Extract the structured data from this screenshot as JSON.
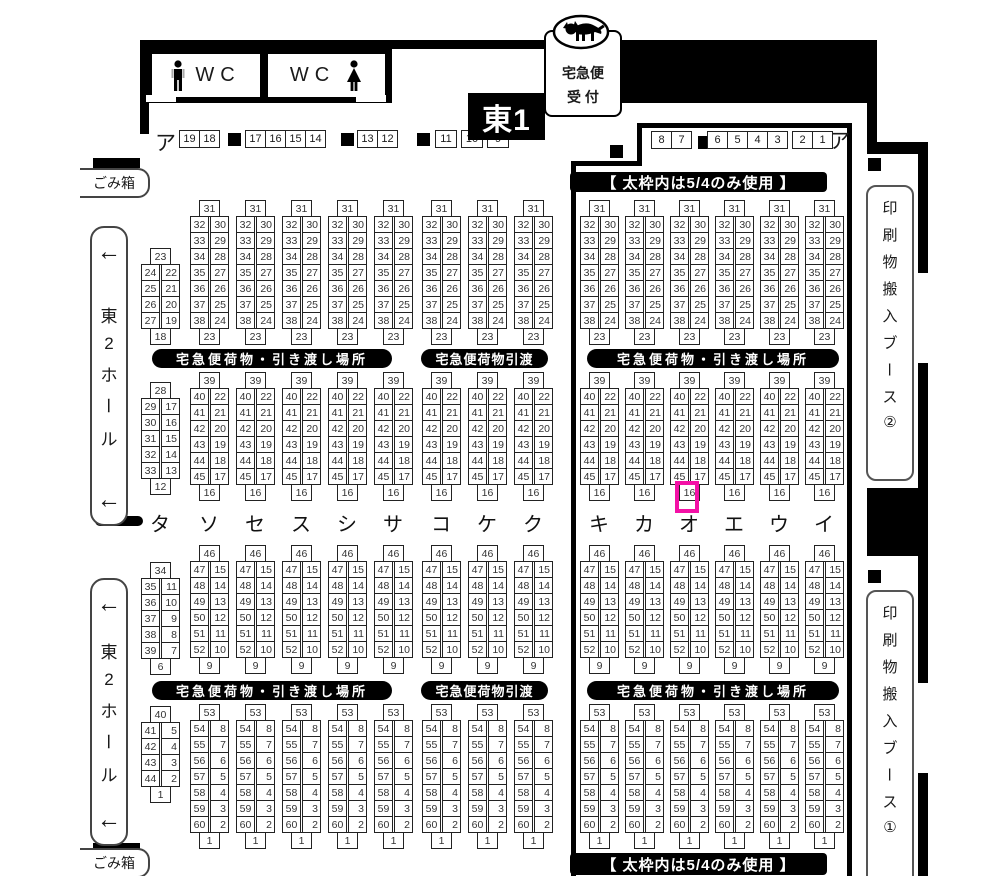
{
  "hall": {
    "name": "東1"
  },
  "courier_sign": {
    "line1": "宅急便",
    "line2": "受 付"
  },
  "wc": {
    "left_label": "WC",
    "right_label": "WC"
  },
  "trash": {
    "top_label": "ごみ箱",
    "bottom_label": "ごみ箱"
  },
  "hall2_sign": {
    "arrow_top": "←",
    "chars": [
      "東",
      "2",
      "ホ",
      "ー",
      "ル"
    ],
    "arrow_bottom": "←"
  },
  "print_booths": {
    "booth2_chars": [
      "印",
      "刷",
      "物",
      "搬",
      "入",
      "ブ",
      "ー",
      "ス",
      "②"
    ],
    "booth1_chars": [
      "印",
      "刷",
      "物",
      "搬",
      "入",
      "ブ",
      "ー",
      "ス",
      "①"
    ]
  },
  "notices": {
    "frame_top": "【 太枠内は5/4のみ使用 】",
    "frame_bottom": "【 太枠内は5/4のみ使用 】"
  },
  "bars": {
    "wide_label": "宅急便荷物・引き渡し場所",
    "narrow_label": "宅急便荷物引渡"
  },
  "row_a": {
    "label_left": "ア",
    "label_right": "ア",
    "left_groups": [
      [
        "19",
        "18"
      ],
      [
        "17",
        "16",
        "15",
        "14"
      ],
      [
        "13",
        "12"
      ]
    ],
    "left_singles": [
      "11",
      "10",
      "9"
    ],
    "right_groups": [
      [
        "8",
        "7"
      ],
      [
        "6",
        "5",
        "4",
        "3"
      ],
      [
        "2",
        "1"
      ]
    ]
  },
  "booth_grid": {
    "partial_column": {
      "label": "タ",
      "sections": [
        {
          "top": "23",
          "rows": [
            [
              "24",
              "22"
            ],
            [
              "25",
              "21"
            ],
            [
              "26",
              "20"
            ],
            [
              "27",
              "19"
            ]
          ],
          "bottom": "18"
        },
        {
          "top": "28",
          "rows": [
            [
              "29",
              "17"
            ],
            [
              "30",
              "16"
            ],
            [
              "31",
              "15"
            ],
            [
              "32",
              "14"
            ],
            [
              "33",
              "13"
            ]
          ],
          "bottom": "12"
        },
        {
          "top": "34",
          "rows": [
            [
              "35",
              "11"
            ],
            [
              "36",
              "10"
            ],
            [
              "37",
              "9"
            ],
            [
              "38",
              "8"
            ],
            [
              "39",
              "7"
            ]
          ],
          "bottom": "6"
        },
        {
          "top": "40",
          "rows": [
            [
              "41",
              "5"
            ],
            [
              "42",
              "4"
            ],
            [
              "43",
              "3"
            ],
            [
              "44",
              "2"
            ]
          ],
          "bottom": "1"
        }
      ]
    },
    "full_sections": [
      {
        "top": "31",
        "rows": [
          [
            "32",
            "30"
          ],
          [
            "33",
            "29"
          ],
          [
            "34",
            "28"
          ],
          [
            "35",
            "27"
          ],
          [
            "36",
            "26"
          ],
          [
            "37",
            "25"
          ],
          [
            "38",
            "24"
          ]
        ],
        "bottom": "23"
      },
      {
        "top": "39",
        "rows": [
          [
            "40",
            "22"
          ],
          [
            "41",
            "21"
          ],
          [
            "42",
            "20"
          ],
          [
            "43",
            "19"
          ],
          [
            "44",
            "18"
          ],
          [
            "45",
            "17"
          ]
        ],
        "bottom": "16"
      },
      {
        "top": "46",
        "rows": [
          [
            "47",
            "15"
          ],
          [
            "48",
            "14"
          ],
          [
            "49",
            "13"
          ],
          [
            "50",
            "12"
          ],
          [
            "51",
            "11"
          ],
          [
            "52",
            "10"
          ]
        ],
        "bottom": "9"
      },
      {
        "top": "53",
        "rows": [
          [
            "54",
            "8"
          ],
          [
            "55",
            "7"
          ],
          [
            "56",
            "6"
          ],
          [
            "57",
            "5"
          ],
          [
            "58",
            "4"
          ],
          [
            "59",
            "3"
          ],
          [
            "60",
            "2"
          ]
        ],
        "bottom": "1"
      }
    ],
    "full_columns": [
      "ソ",
      "セ",
      "ス",
      "シ",
      "サ",
      "コ",
      "ケ",
      "ク",
      "キ",
      "カ",
      "オ",
      "エ",
      "ウ",
      "イ"
    ],
    "highlight": {
      "column": "オ",
      "section_index": 1,
      "cell": "bottom",
      "color": "#f311a6"
    }
  }
}
